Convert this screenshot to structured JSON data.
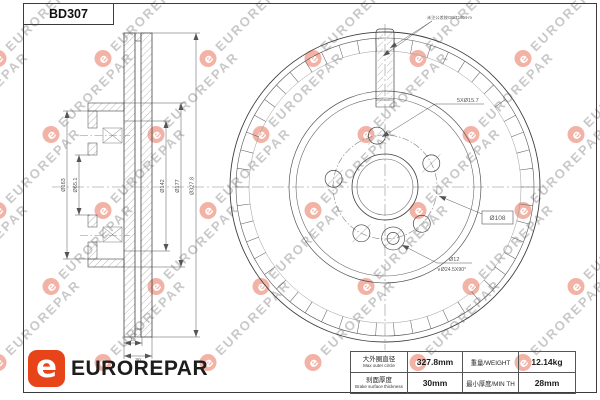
{
  "title": "BD307",
  "brand": {
    "name": "EUROREPAR",
    "logo_letter": "e",
    "accent_color": "#E8441A"
  },
  "watermark": {
    "text": "EUROREPAR",
    "badge_letter": "e",
    "text_color": "#c9c9c9",
    "badge_color": "#f2b3a6"
  },
  "drawing": {
    "front_view": {
      "top_note": "未注公差按GB/T1804-m",
      "holes_label": "5XØ15.7",
      "bolt_circle_label": "Ø108",
      "pin_hole_label": "Ø12",
      "countersink_label": "∨Ø24.5X90°"
    },
    "section_view": {
      "left_dims": [
        "Ø163",
        "Ø65.1"
      ],
      "right_dims": [
        "Ø142",
        "Ø177",
        "Ø327.8"
      ],
      "bottom_dims": [
        "19",
        "30"
      ]
    }
  },
  "spec_table": {
    "rows": [
      {
        "label_cn": "大外圈直径",
        "label_en": "Max outer circle",
        "value": "327.8mm",
        "label2": "重量/WEIGHT",
        "value2": "12.14kg"
      },
      {
        "label_cn": "刹面厚度",
        "label_en": "Brake surface thickness",
        "value": "30mm",
        "label2": "最小厚度/MIN TH",
        "value2": "28mm"
      }
    ]
  },
  "colors": {
    "line": "#444444",
    "dim": "#555555"
  }
}
